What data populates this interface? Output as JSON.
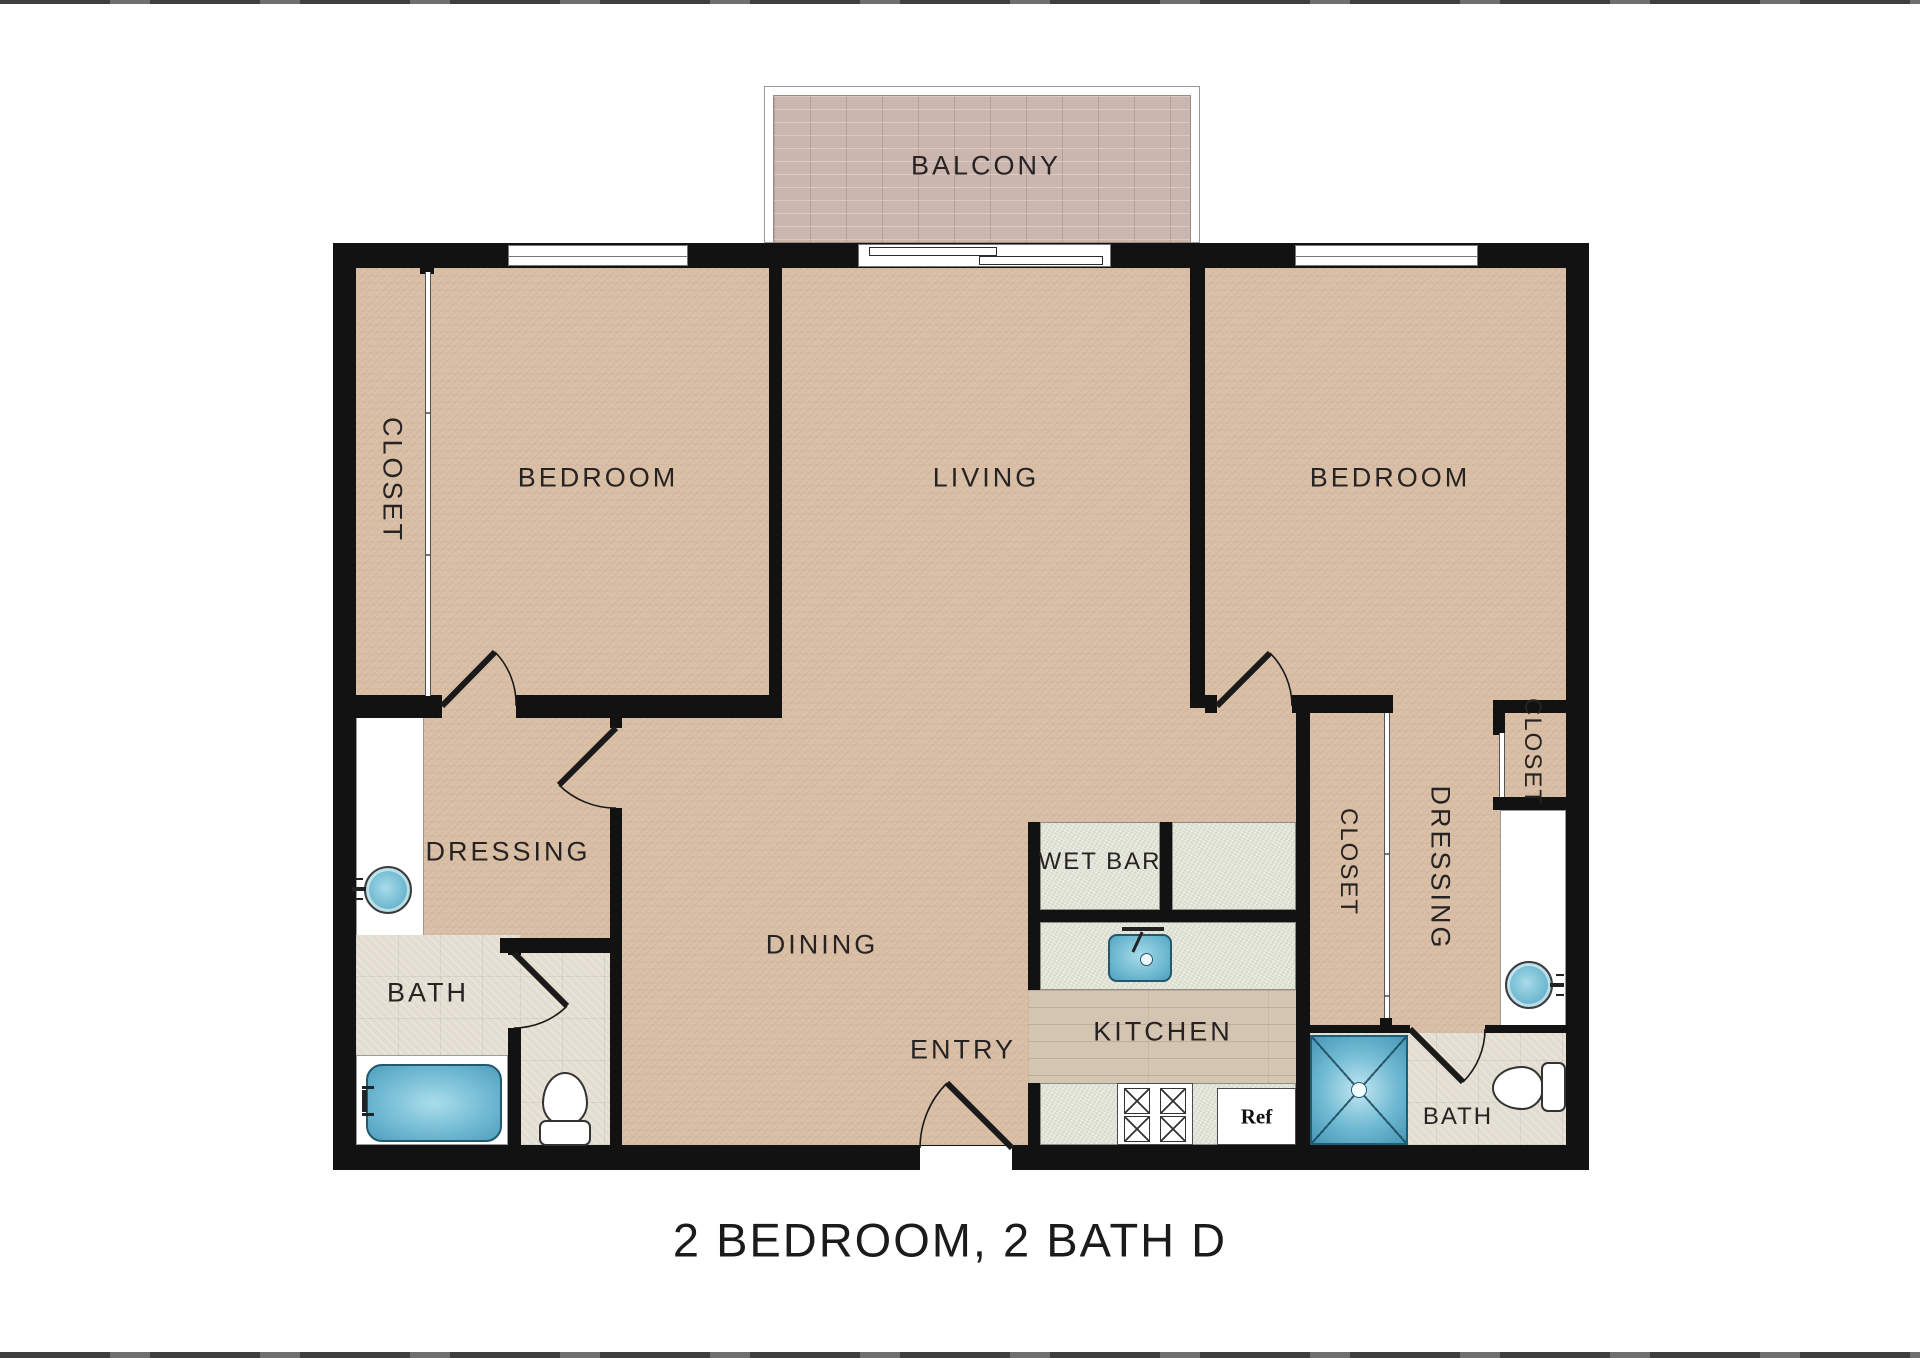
{
  "title": "2 BEDROOM, 2 BATH D",
  "palette": {
    "carpet": "#d9bfa6",
    "wall": "#121212",
    "counter-tile": "#e1e4d6",
    "bath-tile": "#e2ddd0",
    "wood": "#d3c5b1",
    "brick": "#cbb5af",
    "fixture-teal": "#4fa6c3",
    "fixture-teal-border": "#1d5d74",
    "ink": "#272323"
  },
  "rooms": {
    "balcony": "BALCONY",
    "bedroom_left": "BEDROOM",
    "living": "LIVING",
    "bedroom_right": "BEDROOM",
    "closet_left": "CLOSET",
    "dressing_left": "DRESSING",
    "bath_left": "BATH",
    "dining": "DINING",
    "entry": "ENTRY",
    "wet_bar": "WET BAR",
    "kitchen": "KITCHEN",
    "closet_mid": "CLOSET",
    "dressing_right": "DRESSING",
    "closet_right": "CLOSET",
    "bath_right": "BATH",
    "refrigerator": "Ref"
  }
}
